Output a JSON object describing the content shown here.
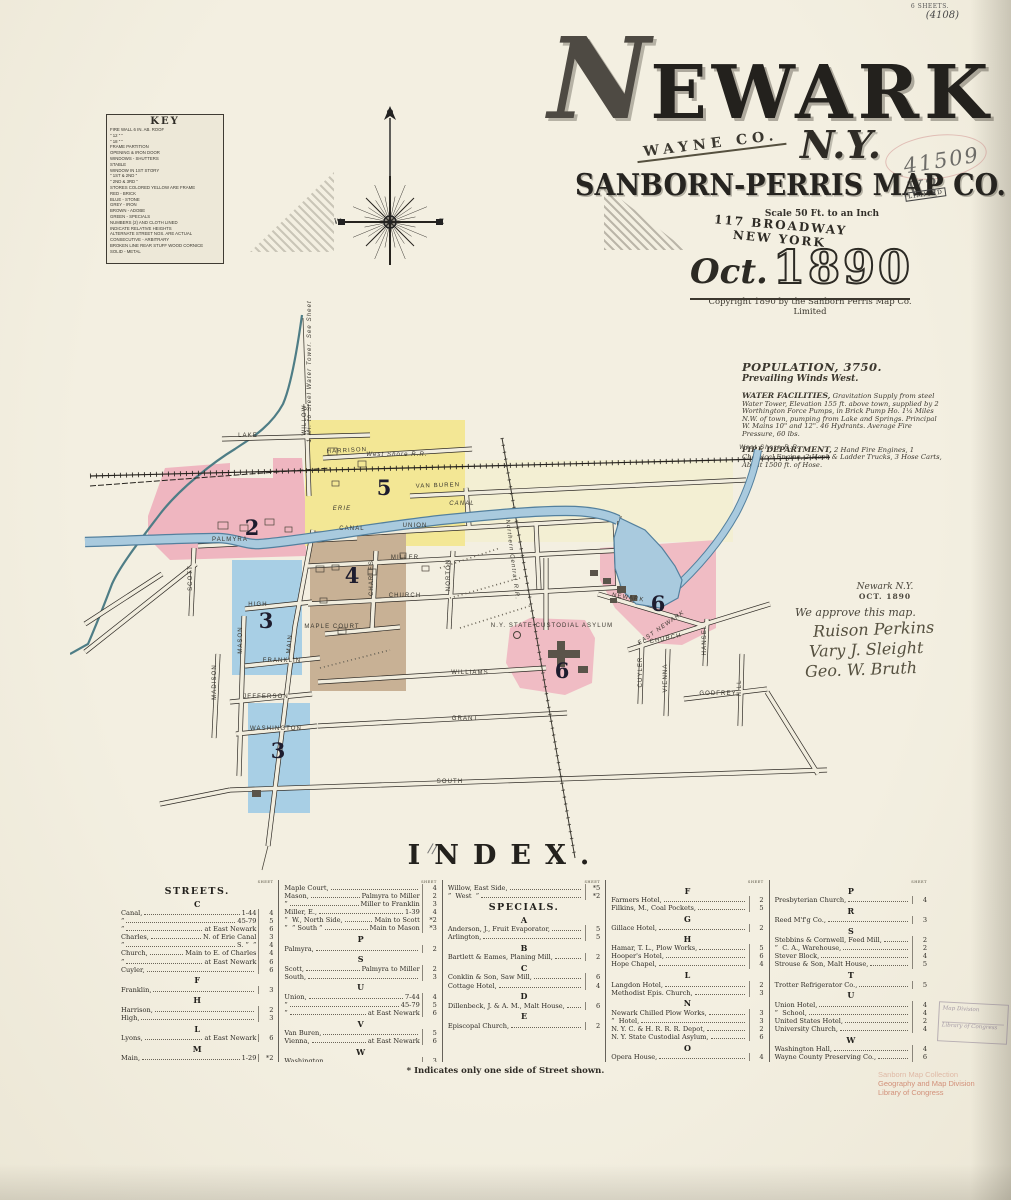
{
  "colors": {
    "paper": "#f1edde",
    "pink": "#efb6c0",
    "pink2": "#f0bcc4",
    "yellow": "#f3e795",
    "pale_yellow": "#f5efc4",
    "blue": "#a8cfe5",
    "tan": "#c8b195",
    "canal": "#a9cade",
    "canal_edge": "#53809e",
    "creek": "#4e7d86"
  },
  "title": {
    "city_initial": "N",
    "city_rest": "EWARK",
    "county": "WAYNE CO.",
    "state": "N.Y.",
    "publisher": "SANBORN-PERRIS MAP CO.",
    "limited": "LIMITED",
    "scale": "Scale 50 Ft. to an Inch",
    "address": "117 BROADWAY NEW YORK",
    "date_month": "Oct.",
    "date_year": "1890",
    "copyright": "Copyright 1890 by the Sanborn Perris Map Co. Limited"
  },
  "annotations": {
    "sheets_note": "6 SHEETS.",
    "catalog_note": "(4108)",
    "accession_number": "41509 V2",
    "stray_mark": "//",
    "approval": {
      "place": "Newark N.Y.",
      "date": "OCT. 1890",
      "statement": "We approve this map.",
      "signatures": [
        "Ruison Perkins",
        "Vary J. Sleight",
        "Geo. W. Bruth"
      ]
    },
    "box_stamp": [
      "Map Division",
      "Library of Congress"
    ],
    "loc_stamp": [
      "Sanborn Map Collection",
      "Geography and Map Division",
      "Library of Congress"
    ]
  },
  "statistics": {
    "population": "POPULATION, 3750.",
    "winds": "Prevailing Winds West.",
    "water_label": "WATER FACILITIES,",
    "water_text": "Gravitation Supply from steel Water Tower, Elevation 155 ft. above town, supplied by 2 Worthington Force Pumps, in Brick Pump Ho. 1¼ Miles N.W. of town, pumping from Lake and Springs. Principal W. Mains 10\" and 12\". 46 Hydrants. Average Fire Pressure, 60 lbs.",
    "fire_label": "FIRE DEPARTMENT,",
    "fire_text": "2 Hand Fire Engines, 1 Chemical Engine, 2 Hook & Ladder Trucks, 3 Hose Carts, About 1500 ft. of Hose."
  },
  "compass": {
    "west": "W",
    "east": "E"
  },
  "key": {
    "title": "KEY",
    "rows": [
      "FIRE WALL 6 IN. AB. ROOF",
      "\"      12 \"      \"",
      "\"      18 \"      \"",
      "FRAME PARTITION",
      "OPENING & IRON DOOR",
      "WINDOWS  -  SHUTTERS",
      "STABLE",
      "WINDOW IN 1ST STORY",
      "\"      1ST & 2ND  \"",
      "\"      2ND & 3RD  \"",
      "STORES COLORED YELLOW ARE FRAME",
      "RED    -    BRICK",
      "BLUE   -    STONE",
      "GREY   -    IRON",
      "BROWN  -    ADOBE",
      "GREEN  -    SPECIALS",
      "NUMBERS (2) AND CLOTH LINED",
      "INDICATE RELATIVE HEIGHTS",
      "ALTERNATE STREET NOS. ARE ACTUAL",
      "CONSECUTIVE  -  ARBITRARY",
      "BROKEN LINE REAR STUFF WOOD CORNICE",
      "SOLID  -  METAL"
    ]
  },
  "map": {
    "labels": [
      {
        "t": "LAKE",
        "x": 178,
        "y": 139
      },
      {
        "t": "HARRISON",
        "x": 277,
        "y": 154,
        "r": -3
      },
      {
        "t": "WILLOW",
        "x": 236,
        "y": 122,
        "r": -90
      },
      {
        "t": "VAN BUREN",
        "x": 368,
        "y": 189,
        "r": -2
      },
      {
        "t": "West Shore R.R.",
        "x": 327,
        "y": 158,
        "i": 1,
        "s": 5.5
      },
      {
        "t": "West Shore R.R.",
        "x": 700,
        "y": 151,
        "i": 1,
        "s": 5.5
      },
      {
        "t": "ERIE",
        "x": 272,
        "y": 212,
        "i": 1,
        "s": 7
      },
      {
        "t": "CANAL",
        "x": 392,
        "y": 207,
        "i": 1,
        "s": 7
      },
      {
        "t": "CANAL",
        "x": 282,
        "y": 232
      },
      {
        "t": "UNION",
        "x": 345,
        "y": 229
      },
      {
        "t": "MILLER",
        "x": 335,
        "y": 261
      },
      {
        "t": "CHURCH",
        "x": 335,
        "y": 299
      },
      {
        "t": "MAPLE COURT",
        "x": 262,
        "y": 330,
        "s": 4.2
      },
      {
        "t": "WILLIAMS",
        "x": 400,
        "y": 376
      },
      {
        "t": "JEFFERSON",
        "x": 196,
        "y": 400,
        "s": 5.2
      },
      {
        "t": "GRANT",
        "x": 395,
        "y": 422
      },
      {
        "t": "WASHINGTON",
        "x": 206,
        "y": 432,
        "s": 4.8
      },
      {
        "t": "SOUTH",
        "x": 380,
        "y": 485
      },
      {
        "t": "FRANKLIN",
        "x": 212,
        "y": 364,
        "s": 5.2
      },
      {
        "t": "HIGH",
        "x": 188,
        "y": 308,
        "s": 5.2
      },
      {
        "t": "PALMYRA",
        "x": 160,
        "y": 243
      },
      {
        "t": "SCOTT",
        "x": 122,
        "y": 280,
        "r": -90,
        "s": 5.2
      },
      {
        "t": "MASON",
        "x": 172,
        "y": 342,
        "r": -90,
        "s": 5.2
      },
      {
        "t": "MADISON",
        "x": 146,
        "y": 384,
        "r": -90,
        "s": 5.2
      },
      {
        "t": "MAIN",
        "x": 221,
        "y": 346,
        "r": -85,
        "s": 7
      },
      {
        "t": "CHARLES",
        "x": 303,
        "y": 280,
        "r": -90,
        "s": 5.2
      },
      {
        "t": "NORTON",
        "x": 380,
        "y": 277,
        "r": -90,
        "s": 5.2
      },
      {
        "t": "NEWARK",
        "x": 558,
        "y": 301,
        "r": 9,
        "s": 5.2
      },
      {
        "t": "EAST NEWARK",
        "x": 592,
        "y": 331,
        "r": -35,
        "s": 11,
        "i": 1,
        "cls": "sl big"
      },
      {
        "t": "CHURCH",
        "x": 596,
        "y": 342,
        "r": -12,
        "s": 4.8
      },
      {
        "t": "CUYLER",
        "x": 572,
        "y": 374,
        "r": -90,
        "s": 4.8
      },
      {
        "t": "VIENNA",
        "x": 597,
        "y": 380,
        "r": -90,
        "s": 4.8
      },
      {
        "t": "HANSEL",
        "x": 636,
        "y": 342,
        "r": -90,
        "s": 4.4
      },
      {
        "t": "HILL",
        "x": 671,
        "y": 390,
        "r": -90,
        "s": 4.8
      },
      {
        "t": "GODFREY",
        "x": 648,
        "y": 397,
        "s": 4.8
      },
      {
        "t": "Northern Central R.R.",
        "x": 441,
        "y": 262,
        "r": 83,
        "s": 4.4,
        "i": 1
      },
      {
        "t": "N.Y. STATE CUSTODIAL ASYLUM",
        "x": 482,
        "y": 329,
        "s": 3.2
      },
      {
        "t": "1 Mi. to Steel Water Tower. See Sheet No. 6",
        "x": 241,
        "y": 62,
        "r": -90,
        "s": 3.4,
        "i": 1
      },
      {
        "t": "2",
        "x": 182,
        "y": 237,
        "cls": "dn"
      },
      {
        "t": "5",
        "x": 314,
        "y": 197,
        "cls": "dn"
      },
      {
        "t": "4",
        "x": 282,
        "y": 285,
        "cls": "dn"
      },
      {
        "t": "3",
        "x": 196,
        "y": 330,
        "cls": "dn"
      },
      {
        "t": "3",
        "x": 208,
        "y": 460,
        "cls": "dn"
      },
      {
        "t": "6",
        "x": 588,
        "y": 313,
        "cls": "dn"
      },
      {
        "t": "6",
        "x": 492,
        "y": 380,
        "cls": "dn"
      }
    ]
  },
  "index": {
    "title": "INDEX.",
    "sheet_label": "SHEET",
    "footnote": "* Indicates only one side of Street shown.",
    "columns": [
      {
        "blocks": [
          {
            "t": "head",
            "v": "STREETS."
          },
          {
            "t": "letter",
            "v": "C"
          },
          {
            "t": "row",
            "n": "Canal,",
            "r": "1-44",
            "s": "4"
          },
          {
            "t": "row",
            "n": "”",
            "r": "45-79",
            "s": "5"
          },
          {
            "t": "row",
            "n": "”",
            "r": "at East Newark",
            "s": "6"
          },
          {
            "t": "row",
            "n": "Charles,",
            "r": "N. of Erie Canal",
            "s": "3"
          },
          {
            "t": "row",
            "n": "”",
            "r": "S. ”  ”",
            "s": "4"
          },
          {
            "t": "row",
            "n": "Church,",
            "r": "Main to E. of Charles",
            "s": "4"
          },
          {
            "t": "row",
            "n": "”",
            "r": "at East Newark",
            "s": "6"
          },
          {
            "t": "row",
            "n": "Cuyler,",
            "r": "",
            "s": "6"
          },
          {
            "t": "letter",
            "v": "F"
          },
          {
            "t": "row",
            "n": "Franklin,",
            "r": "",
            "s": "3"
          },
          {
            "t": "letter",
            "v": "H"
          },
          {
            "t": "row",
            "n": "Harrison,",
            "r": "",
            "s": "2"
          },
          {
            "t": "row",
            "n": "High,",
            "r": "",
            "s": "3"
          },
          {
            "t": "letter",
            "v": "L"
          },
          {
            "t": "row",
            "n": "Lyons,",
            "r": "at East Newark",
            "s": "6"
          },
          {
            "t": "letter",
            "v": "M"
          },
          {
            "t": "row",
            "n": "Main,",
            "r": "1-29",
            "s": "*2"
          },
          {
            "t": "row",
            "n": "”",
            "r": "2-30",
            "s": "*4"
          },
          {
            "t": "row",
            "n": "”",
            "r": "31-71",
            "s": "*3"
          },
          {
            "t": "row",
            "n": "”",
            "r": "Grant to South",
            "s": "3"
          }
        ]
      },
      {
        "blocks": [
          {
            "t": "row",
            "n": "Maple Court,",
            "r": "",
            "s": "4"
          },
          {
            "t": "row",
            "n": "Mason,",
            "r": "Palmyra to Miller",
            "s": "2"
          },
          {
            "t": "row",
            "n": "”",
            "r": "Miller to Franklin",
            "s": "3"
          },
          {
            "t": "row",
            "n": "Miller, E.,",
            "r": "1-39",
            "s": "4"
          },
          {
            "t": "row",
            "n": "”  W., North Side,",
            "r": "Main to Scott",
            "s": "*2"
          },
          {
            "t": "row",
            "n": "”  ” South ”",
            "r": "Main to Mason",
            "s": "*3"
          },
          {
            "t": "letter",
            "v": "P"
          },
          {
            "t": "row",
            "n": "Palmyra,",
            "r": "",
            "s": "2"
          },
          {
            "t": "letter",
            "v": "S"
          },
          {
            "t": "row",
            "n": "Scott,",
            "r": "Palmyra to Miller",
            "s": "2"
          },
          {
            "t": "row",
            "n": "South,",
            "r": "",
            "s": "3"
          },
          {
            "t": "letter",
            "v": "U"
          },
          {
            "t": "row",
            "n": "Union,",
            "r": "7-44",
            "s": "4"
          },
          {
            "t": "row",
            "n": "”",
            "r": "45-79",
            "s": "5"
          },
          {
            "t": "row",
            "n": "”",
            "r": "at East Newark",
            "s": "6"
          },
          {
            "t": "letter",
            "v": "V"
          },
          {
            "t": "row",
            "n": "Van Buren,",
            "r": "",
            "s": "5"
          },
          {
            "t": "row",
            "n": "Vienna,",
            "r": "at East Newark",
            "s": "6"
          },
          {
            "t": "letter",
            "v": "W"
          },
          {
            "t": "row",
            "n": "Washington,",
            "r": "",
            "s": "3"
          },
          {
            "t": "row",
            "n": "Water,",
            "r": "",
            "s": "2"
          }
        ]
      },
      {
        "blocks": [
          {
            "t": "row",
            "n": "Willow, East Side,",
            "r": "",
            "s": "*5"
          },
          {
            "t": "row",
            "n": "”  West  ”",
            "r": "",
            "s": "*2"
          },
          {
            "t": "head",
            "v": "SPECIALS."
          },
          {
            "t": "letter",
            "v": "A"
          },
          {
            "t": "row",
            "n": "Anderson, J., Fruit Evaporator,",
            "r": "",
            "s": "5"
          },
          {
            "t": "row",
            "n": "Arlington,",
            "r": "",
            "s": "5"
          },
          {
            "t": "letter",
            "v": "B"
          },
          {
            "t": "row",
            "n": "Bartlett & Eames, Planing Mill,",
            "r": "",
            "s": "2"
          },
          {
            "t": "letter",
            "v": "C"
          },
          {
            "t": "row",
            "n": "Conklin & Son, Saw Mill,",
            "r": "",
            "s": "6"
          },
          {
            "t": "row",
            "n": "Cottage Hotel,",
            "r": "",
            "s": "4"
          },
          {
            "t": "letter",
            "v": "D"
          },
          {
            "t": "row",
            "n": "Dillenbeck, J. & A. M., Malt House,",
            "r": "",
            "s": "6"
          },
          {
            "t": "letter",
            "v": "E"
          },
          {
            "t": "row",
            "n": "Episcopal Church,",
            "r": "",
            "s": "2"
          }
        ]
      },
      {
        "blocks": [
          {
            "t": "letter",
            "v": "F"
          },
          {
            "t": "row",
            "n": "Farmers Hotel,",
            "r": "",
            "s": "2"
          },
          {
            "t": "row",
            "n": "Filkins, M., Coal Pockets,",
            "r": "",
            "s": "5"
          },
          {
            "t": "letter",
            "v": "G"
          },
          {
            "t": "row",
            "n": "Gillace Hotel,",
            "r": "",
            "s": "2"
          },
          {
            "t": "letter",
            "v": "H"
          },
          {
            "t": "row",
            "n": "Hamar, T. L., Plow Works,",
            "r": "",
            "s": "5"
          },
          {
            "t": "row",
            "n": "Hooper's Hotel,",
            "r": "",
            "s": "6"
          },
          {
            "t": "row",
            "n": "Hope Chapel,",
            "r": "",
            "s": "4"
          },
          {
            "t": "letter",
            "v": "L"
          },
          {
            "t": "row",
            "n": "Langdon Hotel,",
            "r": "",
            "s": "2"
          },
          {
            "t": "row",
            "n": "Methodist Epis. Church,",
            "r": "",
            "s": "3"
          },
          {
            "t": "letter",
            "v": "N"
          },
          {
            "t": "row",
            "n": "Newark Chilled Plow Works,",
            "r": "",
            "s": "3"
          },
          {
            "t": "row",
            "n": "”  Hotel,",
            "r": "",
            "s": "3"
          },
          {
            "t": "row",
            "n": "N. Y. C. & H. R. R. R. Depot,",
            "r": "",
            "s": "2"
          },
          {
            "t": "row",
            "n": "N. Y. State Custodial Asylum,",
            "r": "",
            "s": "6"
          },
          {
            "t": "letter",
            "v": "O"
          },
          {
            "t": "row",
            "n": "Opera House,",
            "r": "",
            "s": "4"
          }
        ]
      },
      {
        "blocks": [
          {
            "t": "letter",
            "v": "P"
          },
          {
            "t": "row",
            "n": "Presbyterian Church,",
            "r": "",
            "s": "4"
          },
          {
            "t": "letter",
            "v": "R"
          },
          {
            "t": "row",
            "n": "Reed M'f'g Co.,",
            "r": "",
            "s": "3"
          },
          {
            "t": "letter",
            "v": "S"
          },
          {
            "t": "row",
            "n": "Stebbins & Cornwell, Feed Mill,",
            "r": "",
            "s": "2"
          },
          {
            "t": "row",
            "n": "”  C. A., Warehouse,",
            "r": "",
            "s": "2"
          },
          {
            "t": "row",
            "n": "Stever Block,",
            "r": "",
            "s": "4"
          },
          {
            "t": "row",
            "n": "Strouse & Son, Malt House,",
            "r": "",
            "s": "5"
          },
          {
            "t": "letter",
            "v": "T"
          },
          {
            "t": "row",
            "n": "Trotter Refrigerator Co.,",
            "r": "",
            "s": "5"
          },
          {
            "t": "letter",
            "v": "U"
          },
          {
            "t": "row",
            "n": "Union Hotel,",
            "r": "",
            "s": "4"
          },
          {
            "t": "row",
            "n": "”  School,",
            "r": "",
            "s": "4"
          },
          {
            "t": "row",
            "n": "United States Hotel,",
            "r": "",
            "s": "2"
          },
          {
            "t": "row",
            "n": "University Church,",
            "r": "",
            "s": "4"
          },
          {
            "t": "letter",
            "v": "W"
          },
          {
            "t": "row",
            "n": "Washington Hall,",
            "r": "",
            "s": "4"
          },
          {
            "t": "row",
            "n": "Wayne County Preserving Co.,",
            "r": "",
            "s": "6"
          },
          {
            "t": "row",
            "n": "Welcher, E., Grist Mill,",
            "r": "",
            "s": "2"
          }
        ]
      }
    ]
  }
}
